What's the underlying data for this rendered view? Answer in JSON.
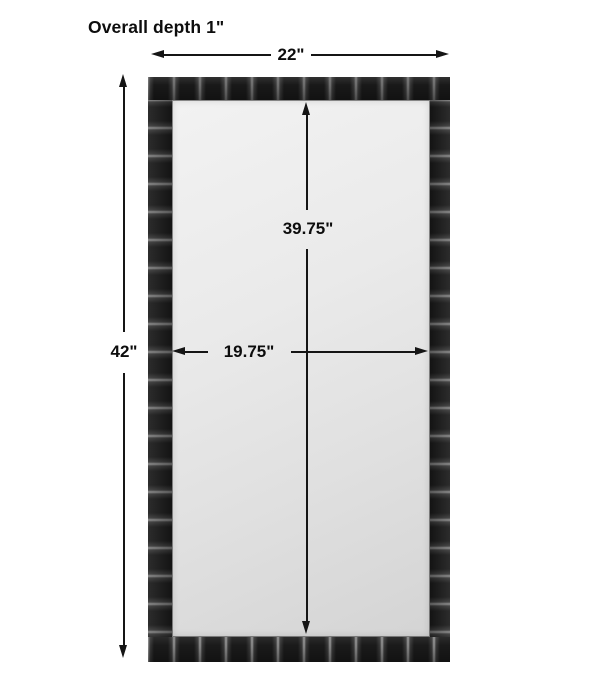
{
  "diagram": {
    "title": "Overall depth 1\"",
    "dimensions": {
      "overall_width": "22\"",
      "overall_height": "42\"",
      "mirror_height": "39.75\"",
      "mirror_width": "19.75\""
    },
    "colors": {
      "background": "#ffffff",
      "line": "#151515",
      "text": "#0d0d0d",
      "frame": "#1c1c1c",
      "frame_mortar": "#7d7d7d",
      "mirror_light": "#f2f2f2",
      "mirror_dark": "#d4d4d4"
    }
  }
}
